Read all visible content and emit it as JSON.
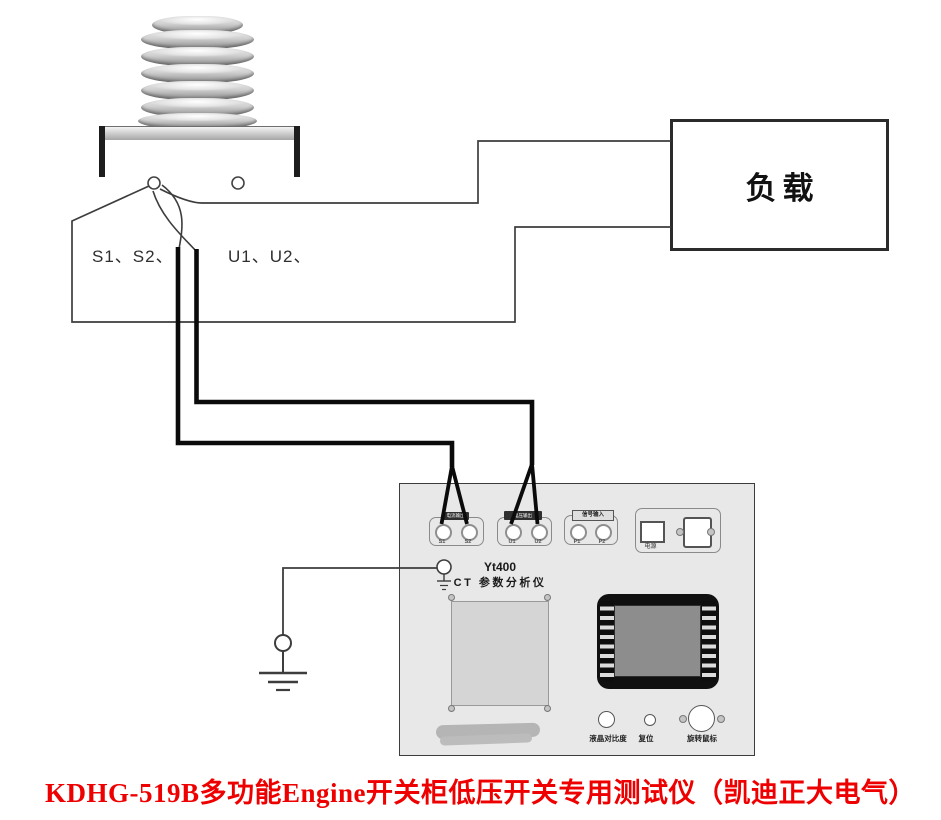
{
  "bushing": {
    "left_terminals_label": "S1、S2、",
    "right_terminals_label": "U1、U2、"
  },
  "load_box": {
    "label": "负载"
  },
  "instrument": {
    "model": "Yt400",
    "name": "CT 参数分析仪",
    "groups": [
      {
        "strip": "电流输出",
        "jack1": "S1",
        "jack2": "S2"
      },
      {
        "strip": "电压输出",
        "jack1": "U1",
        "jack2": "U2"
      },
      {
        "strip": "信号输入",
        "jack1": "P1",
        "jack2": "P2"
      }
    ],
    "power_switch_label": "电源",
    "controls": {
      "contrast": "液晶对比度",
      "reset": "复位",
      "mouse": "旋转鼠标"
    }
  },
  "caption": "KDHG-519B多功能Engine开关柜低压开关专用测试仪（凯迪正大电气）",
  "colors": {
    "caption_red": "#ee0000",
    "thin_wire": "#3d3d3d",
    "thick_wire": "#0b0b0b",
    "panel_bg": "#e8e8e8"
  }
}
